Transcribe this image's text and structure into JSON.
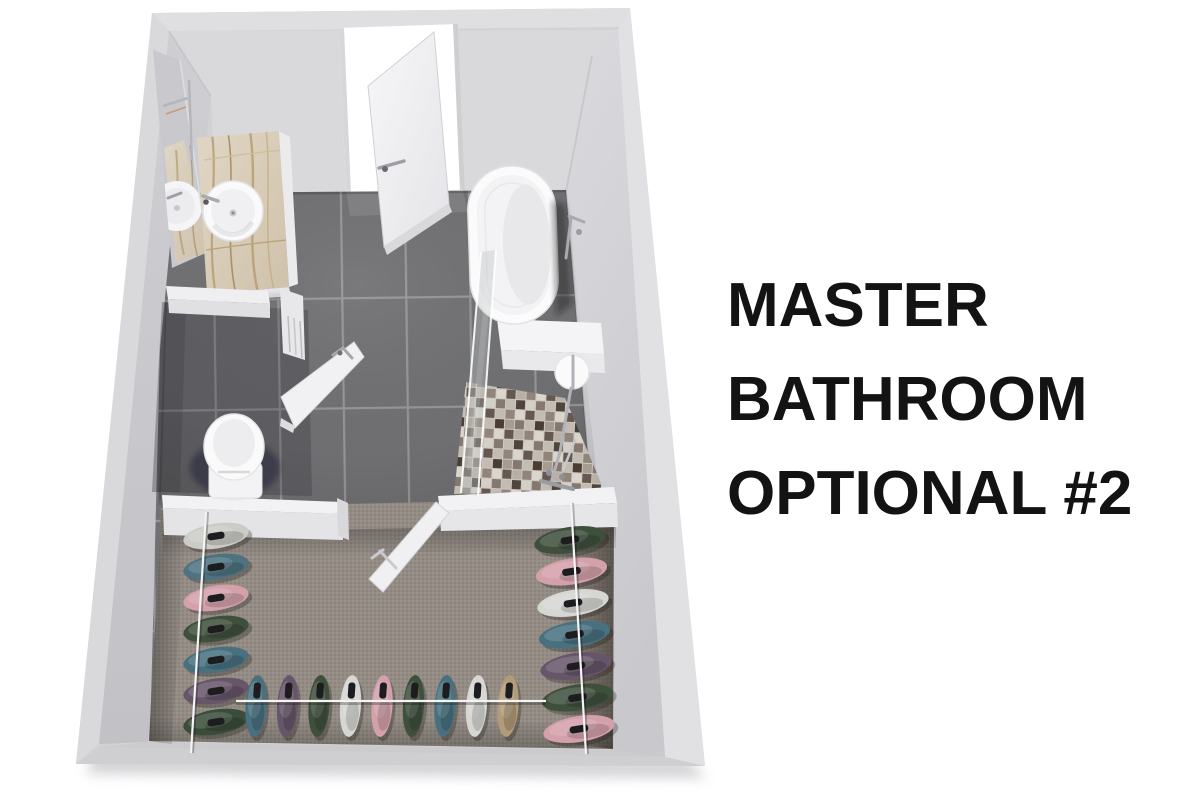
{
  "title": {
    "lines": [
      "MASTER",
      "BATHROOM",
      "OPTIONAL #2"
    ]
  },
  "palette": {
    "background": "#ffffff",
    "wall": "#d2d2d5",
    "wall_light": "#dfdfe2",
    "floor_tile": "#717174",
    "grout": "#97979a",
    "carpet": "#948c85",
    "marble": "#d8cdbb",
    "marble_vein": "#b49a6f",
    "fixture_white": "#f7f7f9",
    "chrome": "#aaabb0",
    "glass": "rgba(188,195,192,0.38)",
    "mosaic_dark": "#6b5e55",
    "mosaic_light": "#e8e3da",
    "text": "#131313"
  },
  "scene": {
    "description": "3D top-down rendering of a master bathroom floor plan with walk-in closet",
    "fixtures": [
      "entry-door",
      "vanity-mirror",
      "vanity-sink",
      "vanity-counter",
      "bathtub",
      "tub-filler-faucet",
      "shower-glass-panel",
      "shower-mosaic-floor",
      "shower-head",
      "toilet",
      "wc-door",
      "divider-wall",
      "closet-door",
      "clothes-rack-left",
      "clothes-rack-right",
      "clothes-rack-bottom",
      "clothes-rails",
      "closet-carpet",
      "tile-floor"
    ]
  },
  "closet": {
    "racks": [
      {
        "name": "clothes-rack-left",
        "x": 216,
        "y": 536,
        "dx": 0,
        "dy": 31,
        "w": 66,
        "h": 25,
        "vertical": false,
        "colors": [
          "#cbcbc7",
          "#4d7280",
          "#d4a0aa",
          "#3e4f3c",
          "#48707f",
          "#675569",
          "#3a4c3a"
        ]
      },
      {
        "name": "clothes-rack-right",
        "x": 570,
        "y": 540,
        "dx": 1.5,
        "dy": 31.5,
        "w": 72,
        "h": 26,
        "vertical": false,
        "colors": [
          "#3e4f3c",
          "#d4a0aa",
          "#d6d6d3",
          "#48707f",
          "#675569",
          "#3e4f3c",
          "#d4a0aa"
        ]
      },
      {
        "name": "clothes-rack-bottom",
        "x": 256,
        "y": 706,
        "dx": 31.5,
        "dy": 0,
        "w": 21,
        "h": 62,
        "vertical": true,
        "colors": [
          "#48707f",
          "#675569",
          "#3e4f3c",
          "#d6d6d3",
          "#d4a0aa",
          "#3e4f3c",
          "#48707f",
          "#d6d6d3",
          "#b19b78"
        ]
      }
    ]
  }
}
